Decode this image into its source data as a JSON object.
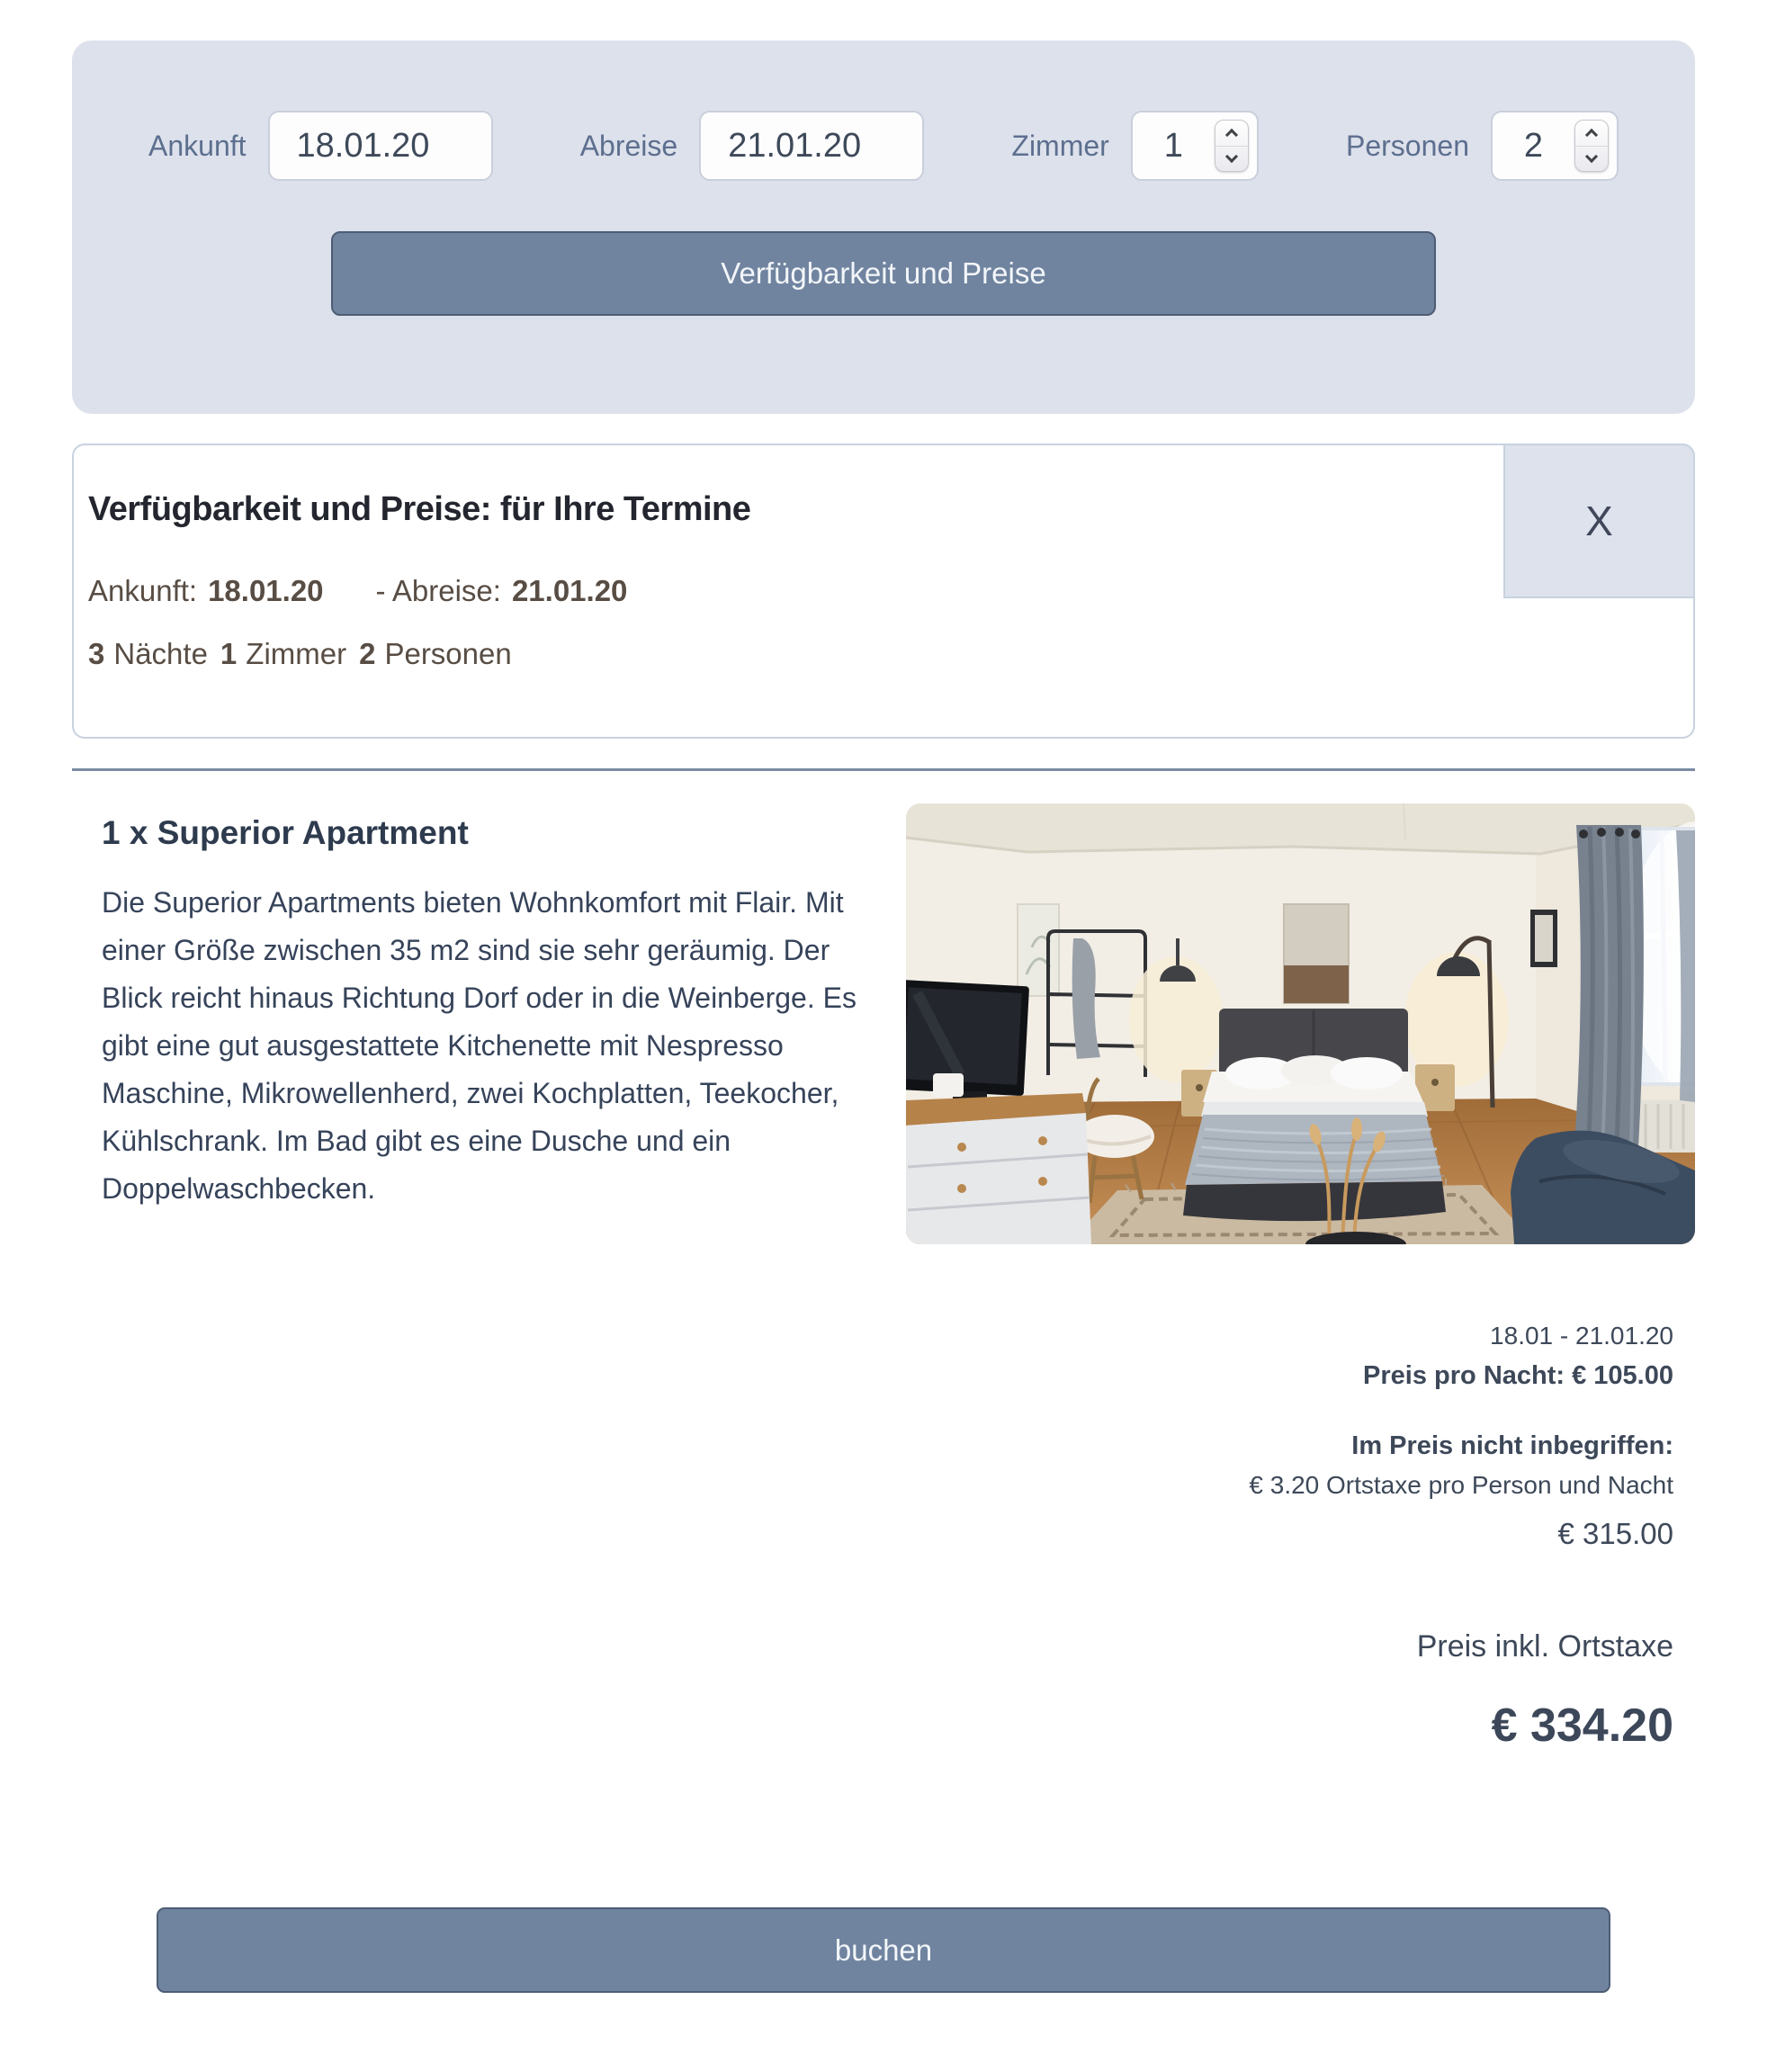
{
  "search_panel": {
    "fields": [
      {
        "label": "Ankunft",
        "value": "18.01.20",
        "type": "date"
      },
      {
        "label": "Abreise",
        "value": "21.01.20",
        "type": "date"
      },
      {
        "label": "Zimmer",
        "value": "1",
        "type": "number"
      },
      {
        "label": "Personen",
        "value": "2",
        "type": "number"
      }
    ],
    "submit_label": "Verfügbarkeit und Preise"
  },
  "results_card": {
    "title": "Verfügbarkeit und Preise: für Ihre Termine",
    "close_label": "X",
    "dates": {
      "arrival_label": "Ankunft:",
      "arrival_value": "18.01.20",
      "departure_label": "- Abreise:",
      "departure_value": "21.01.20"
    },
    "summary": {
      "nights_value": "3",
      "nights_label": "Nächte",
      "rooms_value": "1",
      "rooms_label": "Zimmer",
      "persons_value": "2",
      "persons_label": "Personen"
    }
  },
  "apartment": {
    "title": "1 x Superior Apartment",
    "description": "Die Superior Apartments bieten Wohnkomfort mit Flair. Mit einer Größe zwischen 35 m2 sind sie sehr geräumig. Der Blick reicht hinaus Richtung Dorf oder in die Weinberge. Es gibt eine gut ausgestattete Kitchenette mit Nespresso Maschine, Mikrowellenherd, zwei Kochplatten, Teekocher, Kühlschrank. Im Bad gibt es eine Dusche und ein Doppelwaschbecken.",
    "photo_label": "Superior Apartment Schlafzimmer"
  },
  "pricing": {
    "date_range": "18.01 - 21.01.20",
    "price_per_night": "Preis pro Nacht: € 105.00",
    "not_included_label": "Im Preis nicht inbegriffen:",
    "city_tax": "€ 3.20 Ortstaxe pro Person und Nacht",
    "subtotal": "€ 315.00",
    "total_label": "Preis inkl. Ortstaxe",
    "total": "€ 334.20"
  },
  "book_button_label": "buchen",
  "colors": {
    "accent_button": "#7084a0",
    "panel_bg": "#dce1eb",
    "close_box_bg": "#dde2ec",
    "divider": "#7b8ca4",
    "text_dark_slate": "#36435a",
    "text_brown": "#584d44",
    "label_blue": "#5d6f8f"
  }
}
